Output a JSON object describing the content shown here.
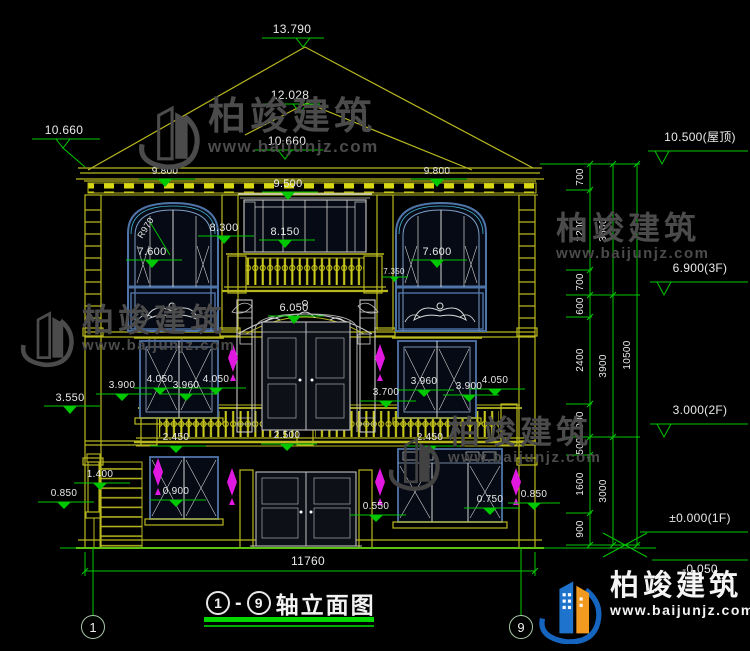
{
  "brand": {
    "name": "柏竣建筑",
    "url": "www.baijunjz.com"
  },
  "title": {
    "axis_left": "1",
    "dash": "-",
    "axis_right": "9",
    "text": "轴立面图"
  },
  "axis": {
    "left": "1",
    "right": "9"
  },
  "levels": {
    "peak": "13.790",
    "peak2": "12.028",
    "eaveL": "10.660",
    "eaveC": "10.660",
    "roofR": "10.500(屋顶)",
    "f3": "6.900(3F)",
    "f2": "3.000(2F)",
    "f1": "±0.000(1F)",
    "below": "-0.050",
    "c980a": "9.800",
    "c980b": "9.800",
    "w950": "9.500",
    "m830": "8.300",
    "m815": "8.150",
    "w760a": "7.600",
    "w760b": "7.600",
    "m735": "7.350",
    "m605": "6.050",
    "m355": "3.550",
    "s390a": "3.900",
    "s405a": "4.050",
    "s396a": "3.960",
    "s405b": "4.050",
    "m370": "3.700",
    "s396b": "3.960",
    "s390b": "3.900",
    "s405c": "4.050",
    "b245a": "2.450",
    "b250": "2.500",
    "b245b": "2.450",
    "m140": "1.400",
    "m085a": "0.850",
    "m090": "0.900",
    "m055": "0.550",
    "m075": "0.750",
    "m085b": "0.850",
    "radius": "R970"
  },
  "dims": {
    "total": "11760",
    "seg700a": "700",
    "seg2200": "2200",
    "seg700b": "700",
    "seg600": "600",
    "seg2400": "2400",
    "seg900a": "900",
    "seg500": "500",
    "seg1600": "1600",
    "seg900b": "900",
    "sub3600": "3600",
    "sub3900": "3900",
    "sub3000": "3000",
    "grand": "10500"
  }
}
